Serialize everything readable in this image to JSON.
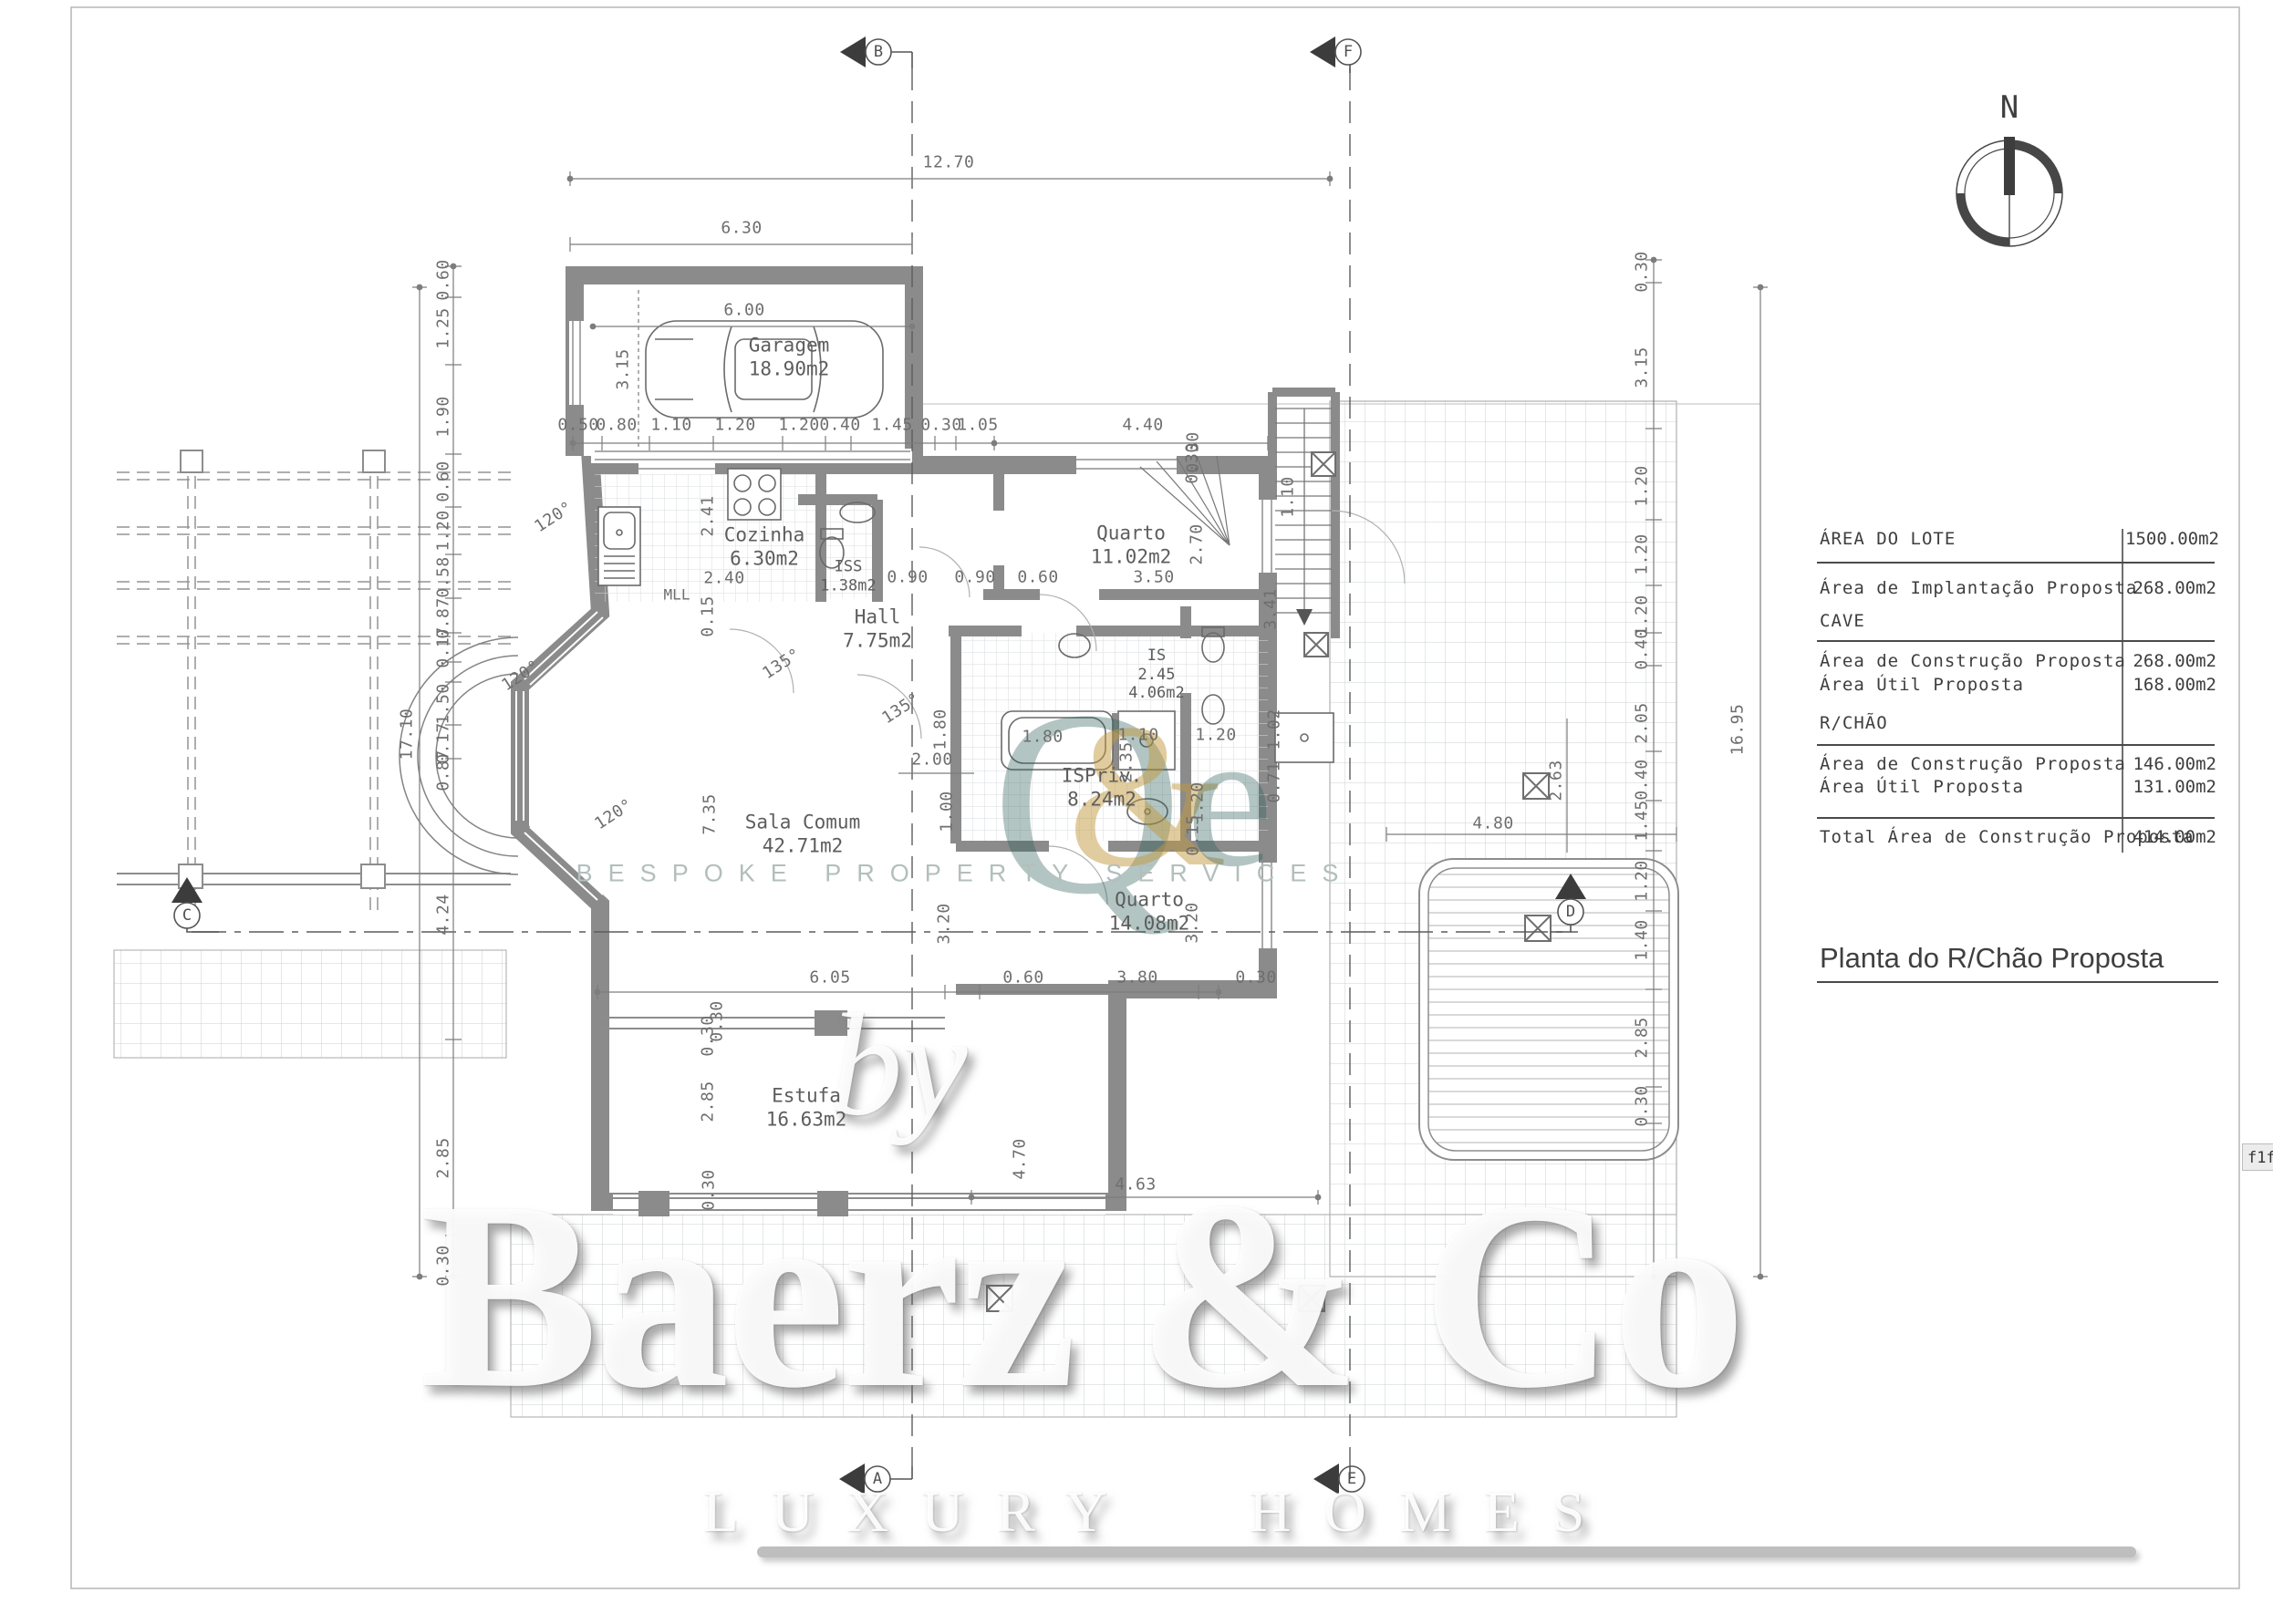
{
  "title": "Planta do R/Chão Proposta",
  "compass": {
    "north_label": "N"
  },
  "area_table": {
    "lot_label": "ÁREA DO LOTE",
    "lot_value": "1500.00m2",
    "implant_label": "Área de Implantação Proposta",
    "implant_value": "268.00m2",
    "cave_header": "CAVE",
    "cave_constr_label": "Área de Construção Proposta",
    "cave_constr_value": "268.00m2",
    "cave_util_label": "Área Útil Proposta",
    "cave_util_value": "168.00m2",
    "rchao_header": "R/CHÃO",
    "rchao_constr_label": "Área de Construção Proposta",
    "rchao_constr_value": "146.00m2",
    "rchao_util_label": "Área Útil Proposta",
    "rchao_util_value": "131.00m2",
    "total_label": "Total Área de Construção Proposta",
    "total_value": "414.00m2"
  },
  "rooms": [
    {
      "name": "Garagem",
      "area": "18.90m2"
    },
    {
      "name": "Cozinha",
      "area": "6.30m2"
    },
    {
      "name": "ISS",
      "area": "1.38m2"
    },
    {
      "name": "Hall",
      "area": "7.75m2"
    },
    {
      "name": "Quarto",
      "area": "11.02m2"
    },
    {
      "name": "IS",
      "dim": "2.45",
      "area": "4.06m2"
    },
    {
      "name": "ISPriv.",
      "area": "8.24m2"
    },
    {
      "name": "Quarto",
      "area": "14.08m2"
    },
    {
      "name": "Sala Comum",
      "area": "42.71m2"
    },
    {
      "name": "Estufa",
      "area": "16.63m2"
    }
  ],
  "labels": {
    "mll": "MLL"
  },
  "dims": [
    "12.70",
    "6.30",
    "6.00",
    "3.15",
    "0.50",
    "0.80",
    "1.10",
    "1.20",
    "1.20",
    "0.40",
    "1.45",
    "0.30",
    "1.05",
    "4.40",
    "0.30",
    "1.10",
    "2.41",
    "2.40",
    "0.15",
    "0.90",
    "0.90",
    "0.60",
    "3.50",
    "2.70",
    "0.30",
    "3.41",
    "135°",
    "135°",
    "120°",
    "120°",
    "120°",
    "1.80",
    "2.00",
    "1.00",
    "3.20",
    "3.20",
    "7.35",
    "6.05",
    "0.60",
    "3.80",
    "0.30",
    "0.30",
    "2.85",
    "0.30",
    "0.30",
    "4.70",
    "4.63",
    "1.80",
    "1.10",
    "1.20",
    "1.02",
    "0.71",
    "1.20",
    "0.15",
    "2.35",
    "2.63",
    "4.80",
    "17.10",
    "16.95"
  ],
  "dims_left": [
    "0.60",
    "1.25",
    "1.90",
    "0.60",
    "1.20",
    "0.58",
    "0.87",
    "0.17",
    "1.50",
    "0.17",
    "0.87",
    "4.24",
    "2.85",
    "0.30"
  ],
  "dims_right": [
    "0.30",
    "3.15",
    "1.20",
    "1.20",
    "1.20",
    "0.40",
    "2.05",
    "0.40",
    "1.45",
    "1.20",
    "1.40",
    "2.85",
    "0.30"
  ],
  "markers": {
    "a": "A",
    "b": "B",
    "c": "C",
    "d": "D",
    "e": "E",
    "f": "F"
  },
  "watermark": {
    "by": "by",
    "brand": "Baerz & Co",
    "tagline": "LUXURY HOMES",
    "services": "BESPOKE PROPERTY SERVICES",
    "logo_q": "Q",
    "logo_amp": "&",
    "logo_e": "e"
  },
  "artifact": {
    "clipped_text": "f1f"
  }
}
